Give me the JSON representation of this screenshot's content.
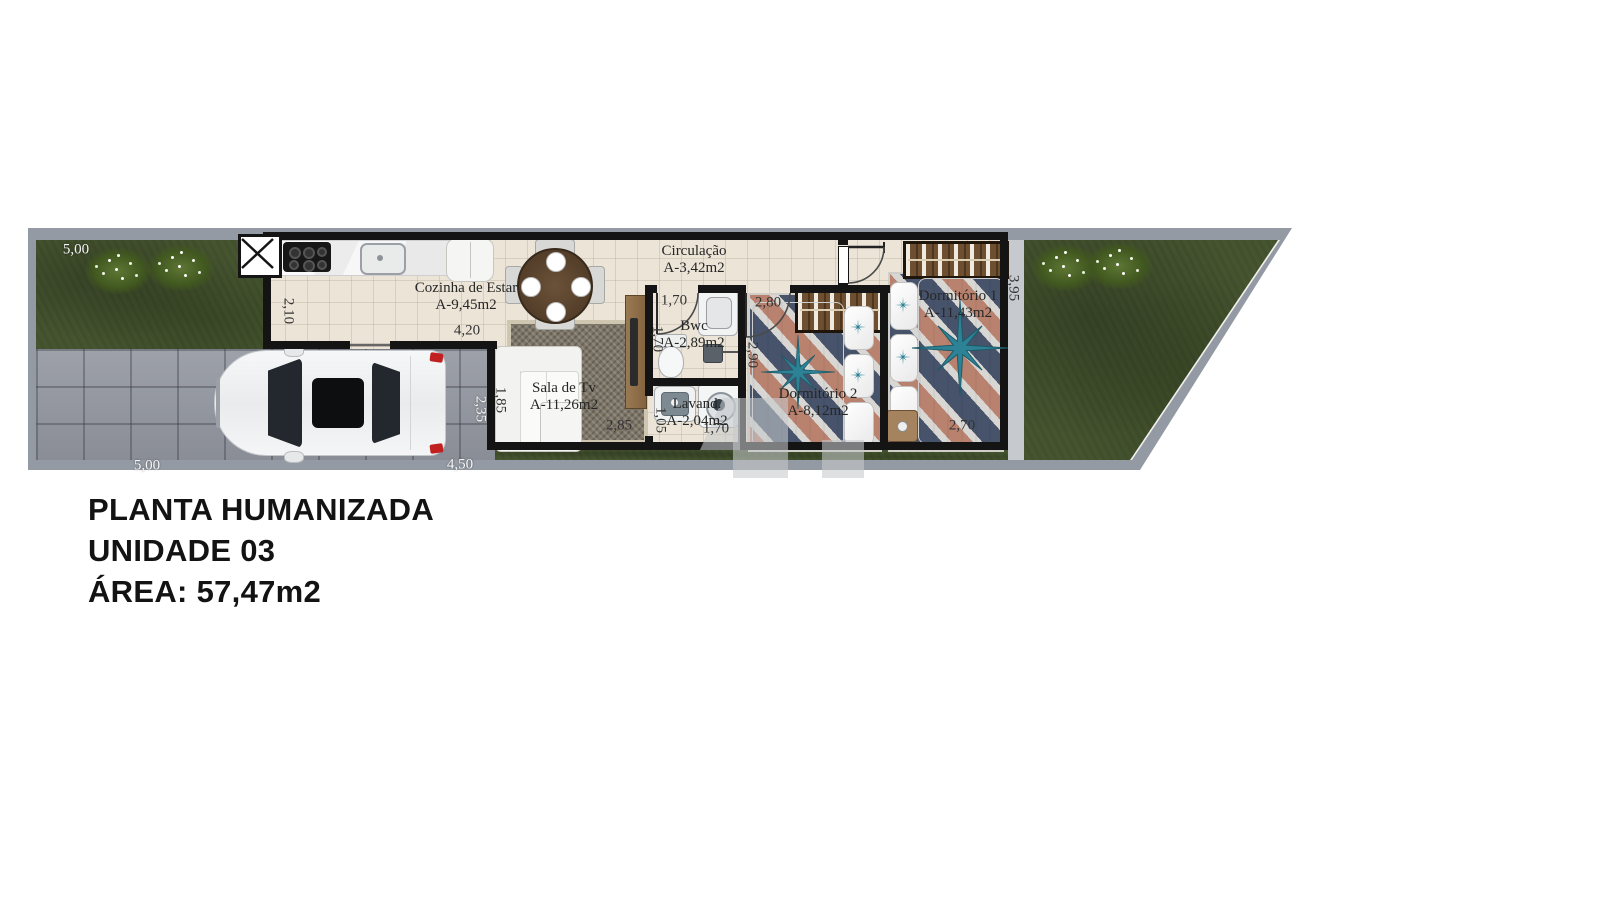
{
  "title_block": {
    "line1": "PLANTA HUMANIZADA",
    "line2": "UNIDADE 03",
    "line3": "ÁREA: 57,47m2"
  },
  "rooms": [
    {
      "name": "Cozinha de Estar",
      "area": "A-9,45m2"
    },
    {
      "name": "Circulação",
      "area": "A-3,42m2"
    },
    {
      "name": "Bwc",
      "area": "A-2,89m2"
    },
    {
      "name": "Sala de Tv",
      "area": "A-11,26m2"
    },
    {
      "name": "Lavand.",
      "area": "A-2,04m2"
    },
    {
      "name": "Dormitório 2",
      "area": "A-8,12m2"
    },
    {
      "name": "Dormitório 1",
      "area": "A-11,43m2"
    }
  ],
  "dimensions": [
    {
      "text": "5,00"
    },
    {
      "text": "2,10"
    },
    {
      "text": "4,20"
    },
    {
      "text": "1,70"
    },
    {
      "text": "1,70"
    },
    {
      "text": "2,80"
    },
    {
      "text": "2,90"
    },
    {
      "text": "1,85"
    },
    {
      "text": "2,35"
    },
    {
      "text": "2,85"
    },
    {
      "text": "1,05"
    },
    {
      "text": "1,70"
    },
    {
      "text": "2,70"
    },
    {
      "text": "3,95"
    },
    {
      "text": "5,00"
    },
    {
      "text": "4,50"
    }
  ],
  "furniture_items": [
    "kitchen-counter",
    "cooktop",
    "kitchen-sink",
    "fridge",
    "dining-table",
    "dining-chairs",
    "sofa",
    "sala-rug",
    "tv-rack",
    "toilet",
    "vanity-sink",
    "shower",
    "laundry-sink",
    "washing-machine",
    "wardrobe-dorm1",
    "wardrobe-dorm2",
    "double-bed-dorm1",
    "double-bed-dorm2",
    "nightstand",
    "car",
    "plants",
    "window"
  ],
  "colors": {
    "grass": "#465530",
    "paver": "#9599a2",
    "floor": "#ebe4d7",
    "wall": "#141414",
    "curb": "#939aa3",
    "compass_teal": "#2d8295",
    "rug_navy": "#46536b",
    "rug_salmon": "#b9826e",
    "taillight_red": "#c02020"
  }
}
